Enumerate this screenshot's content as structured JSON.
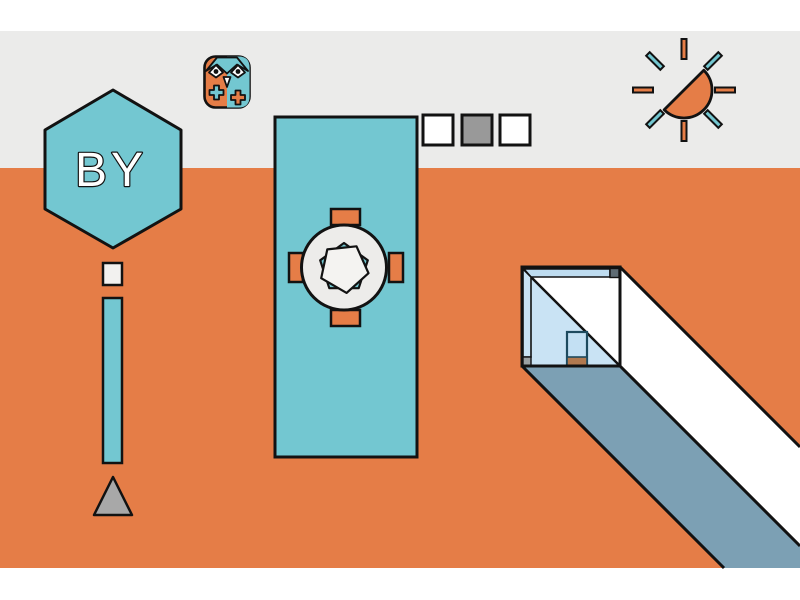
{
  "illustration": {
    "hexagon_label": "BY",
    "icons": {
      "logo": "owl-icon",
      "sun": "sun-icon"
    },
    "colors": {
      "orange": "#E57D47",
      "teal": "#73C7D1",
      "sky_gray": "#EBEBEA",
      "page_white": "#FFFFFF",
      "table_gray": "#EDECEA",
      "pentagon_white": "#F4F3F1",
      "slate_blue": "#7CA0B4",
      "wall_blue": "#C9E3F4",
      "ceiling_blue": "#BEDCF0",
      "door_blue": "#C3E0F3",
      "threshold_brown": "#B1794F",
      "triangle_gray": "#A8A8A8",
      "marker_dot_white": "#F2F1EF",
      "corner_dark_gray": "#5F6C74",
      "foot_gray": "#9BA1A3",
      "outline_black": "#121212",
      "door_outline": "#1D4A5E",
      "text_white": "#FFFFFF"
    },
    "swatches": {
      "items": [
        {
          "fill": "#FFFFFF"
        },
        {
          "fill": "#999999"
        },
        {
          "fill": "#FFFFFF"
        }
      ]
    }
  }
}
